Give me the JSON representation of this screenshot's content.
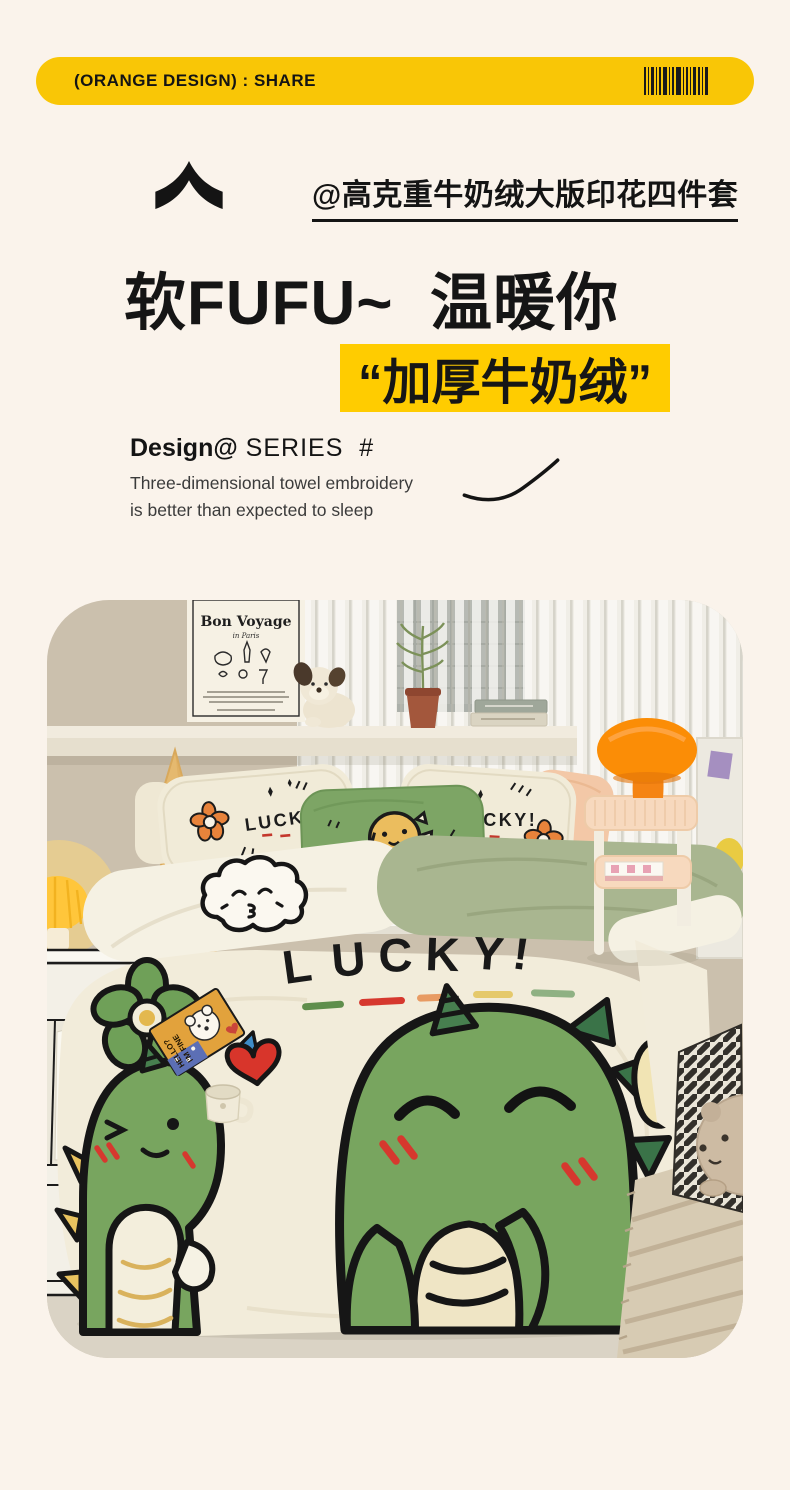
{
  "page": {
    "background": "#FAF3EB",
    "bottom_strip_color": "#FFFFFF"
  },
  "banner": {
    "label": "(ORANGE DESIGN) : SHARE",
    "background": "#F9C606",
    "text_color": "#141414",
    "barcode_icon": "barcode"
  },
  "hero": {
    "subtitle": "@高克重牛奶绒大版印花四件套",
    "headline": "软FUFU~  温暖你",
    "highlight": "“加厚牛奶绒”",
    "highlight_background": "#FFCC00",
    "series_bold": "Design@",
    "series_rest": " SERIES  #",
    "description_line1": "Three-dimensional towel embroidery",
    "description_line2": "is better than expected to sleep"
  },
  "photo": {
    "poster": {
      "title": "Bon Voyage",
      "subtitle": "in Paris"
    },
    "pillow_left_word": "LUCKY!",
    "pillow_right_word": "LUCKY!",
    "duvet_letters": [
      "L",
      "U",
      "C",
      "K",
      "Y",
      "!"
    ],
    "card": {
      "line1": "HELLO?",
      "line2": "I'M FINE"
    },
    "colors": {
      "dino_green": "#78A55F",
      "dark_spike_green": "#3A7348",
      "sage_green": "#A9B690",
      "duvet_cream": "#F2ECDA",
      "pillow_cream": "#F1EBD8",
      "pillow_green": "#7DA565",
      "pillow_peach": "#F3C8A7",
      "lamp_orange": "#FB8D06",
      "heart_red": "#D8352B",
      "wall_tan": "#CBC0AD",
      "wood": "#E5B96F"
    }
  }
}
